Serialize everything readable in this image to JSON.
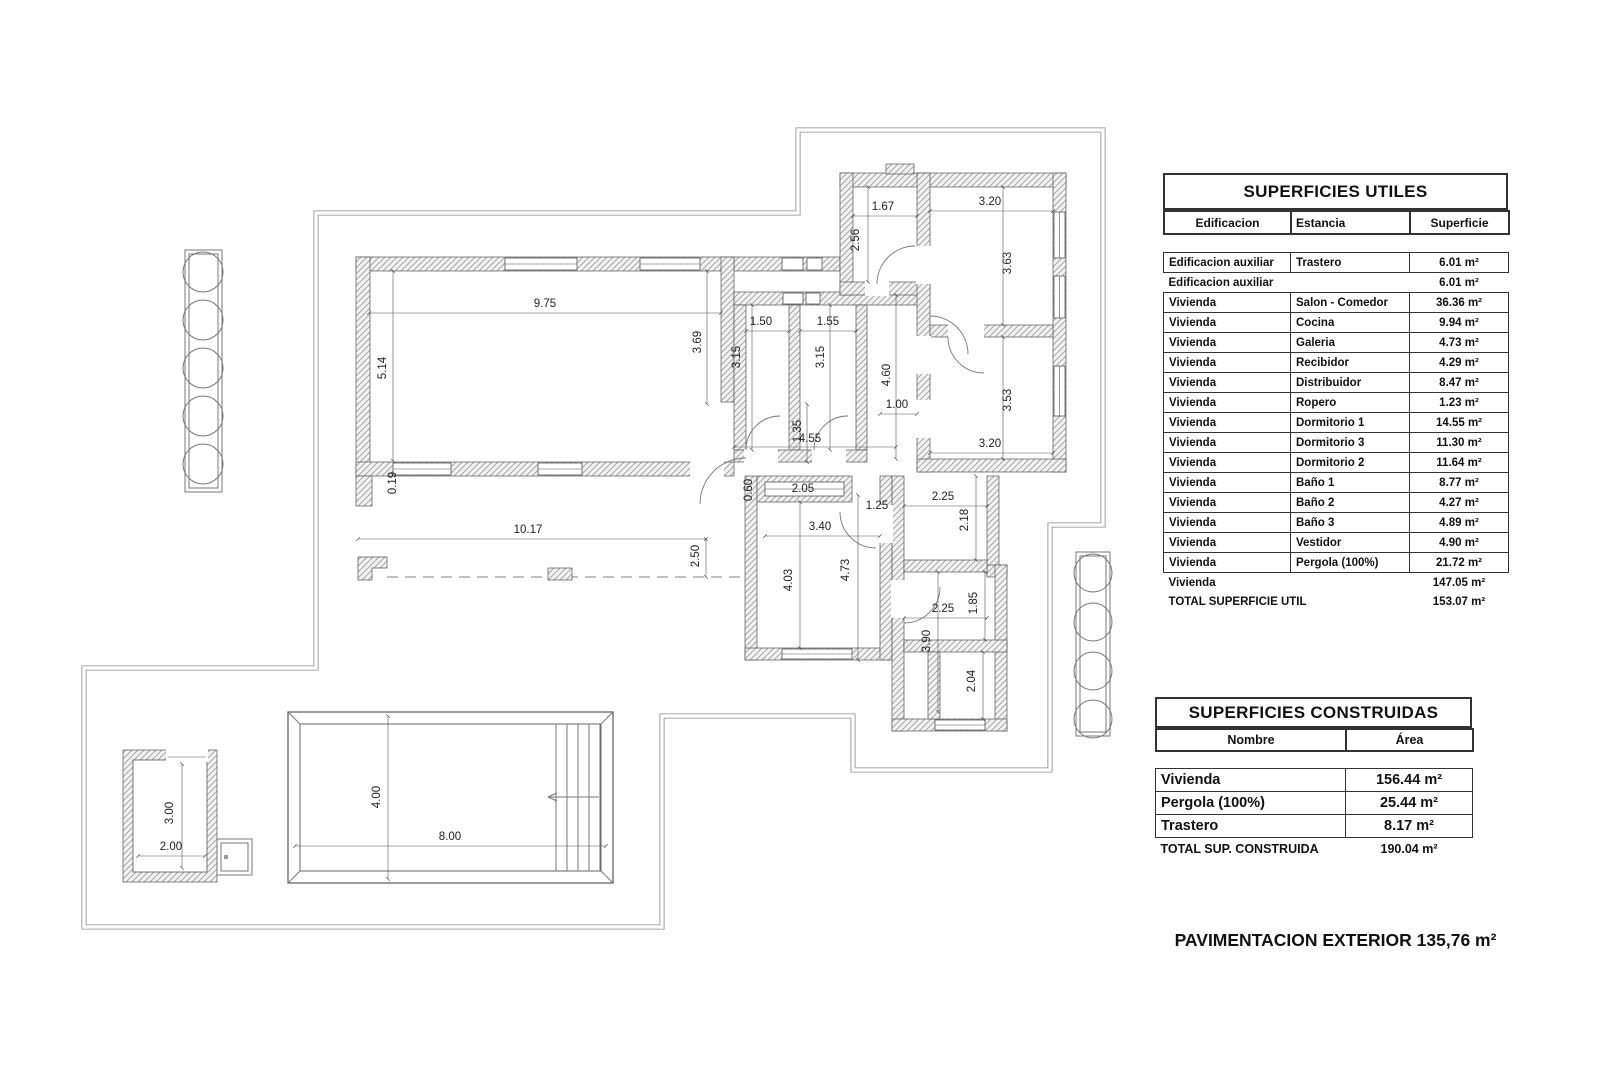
{
  "plan": {
    "dimensions": [
      [
        "9.75",
        545,
        307,
        0
      ],
      [
        "5.14",
        386,
        368,
        1
      ],
      [
        "3.69",
        701,
        342,
        1
      ],
      [
        "1.50",
        761,
        325,
        0
      ],
      [
        "1.55",
        828,
        325,
        0
      ],
      [
        "3.15",
        740,
        357,
        1
      ],
      [
        "3.15",
        824,
        357,
        1
      ],
      [
        "1.67",
        883,
        210,
        0
      ],
      [
        "2.56",
        859,
        240,
        1
      ],
      [
        "3.20",
        990,
        205,
        0
      ],
      [
        "3.63",
        1011,
        263,
        1
      ],
      [
        "3.53",
        1011,
        400,
        1
      ],
      [
        "3.20",
        990,
        447,
        0
      ],
      [
        "4.60",
        890,
        375,
        1
      ],
      [
        "1.00",
        897,
        408,
        0
      ],
      [
        "4.55",
        810,
        442,
        0
      ],
      [
        "1.35",
        801,
        431,
        1
      ],
      [
        "0.60",
        752,
        490,
        1
      ],
      [
        "2.05",
        803,
        492,
        0
      ],
      [
        "1.25",
        877,
        509,
        0
      ],
      [
        "3.40",
        820,
        530,
        0
      ],
      [
        "2.50",
        699,
        556,
        1
      ],
      [
        "10.17",
        528,
        533,
        0
      ],
      [
        "0.19",
        396,
        483,
        1
      ],
      [
        "4.03",
        792,
        580,
        1
      ],
      [
        "4.73",
        849,
        570,
        1
      ],
      [
        "2.25",
        943,
        500,
        0
      ],
      [
        "2.18",
        968,
        520,
        1
      ],
      [
        "2.25",
        943,
        612,
        0
      ],
      [
        "1.85",
        977,
        603,
        1
      ],
      [
        "3.90",
        930,
        641,
        1
      ],
      [
        "2.04",
        975,
        681,
        1
      ],
      [
        "4.00",
        380,
        797,
        1
      ],
      [
        "8.00",
        450,
        840,
        0
      ],
      [
        "3.00",
        173,
        813,
        1
      ],
      [
        "2.00",
        171,
        850,
        0
      ]
    ]
  },
  "tables": {
    "utiles": {
      "title": "SUPERFICIES UTILES",
      "headers": [
        "Edificacion",
        "Estancia",
        "Superficie"
      ],
      "rows": [
        [
          "Edificacion auxiliar",
          "Trastero",
          "6.01 m²"
        ],
        [
          "Edificacion auxiliar",
          "",
          "6.01 m²"
        ],
        [
          "Vivienda",
          "Salon - Comedor",
          "36.36 m²"
        ],
        [
          "Vivienda",
          "Cocina",
          "9.94 m²"
        ],
        [
          "Vivienda",
          "Galeria",
          "4.73 m²"
        ],
        [
          "Vivienda",
          "Recibidor",
          "4.29 m²"
        ],
        [
          "Vivienda",
          "Distribuidor",
          "8.47 m²"
        ],
        [
          "Vivienda",
          "Ropero",
          "1.23 m²"
        ],
        [
          "Vivienda",
          "Dormitorio 1",
          "14.55 m²"
        ],
        [
          "Vivienda",
          "Dormitorio 3",
          "11.30 m²"
        ],
        [
          "Vivienda",
          "Dormitorio 2",
          "11.64 m²"
        ],
        [
          "Vivienda",
          "Baño 1",
          "8.77 m²"
        ],
        [
          "Vivienda",
          "Baño 2",
          "4.27 m²"
        ],
        [
          "Vivienda",
          "Baño 3",
          "4.89 m²"
        ],
        [
          "Vivienda",
          "Vestidor",
          "4.90 m²"
        ],
        [
          "Vivienda",
          "Pergola   (100%)",
          "21.72 m²"
        ]
      ],
      "unboxed": [
        1
      ],
      "subtotal": {
        "label": "Vivienda",
        "value": "147.05 m²"
      },
      "total": {
        "label": "TOTAL SUPERFICIE UTIL",
        "value": "153.07 m²"
      }
    },
    "construidas": {
      "title": "SUPERFICIES CONSTRUIDAS",
      "headers": [
        "Nombre",
        "Área"
      ],
      "rows": [
        [
          "Vivienda",
          "156.44 m²"
        ],
        [
          "Pergola  (100%)",
          "25.44 m²"
        ],
        [
          "Trastero",
          "8.17 m²"
        ]
      ],
      "unboxed": [],
      "total": {
        "label": "TOTAL SUP. CONSTRUIDA",
        "value": "190.04 m²"
      }
    }
  },
  "footer": {
    "exterior_title": "PAVIMENTACION EXTERIOR 135,76 m²"
  }
}
